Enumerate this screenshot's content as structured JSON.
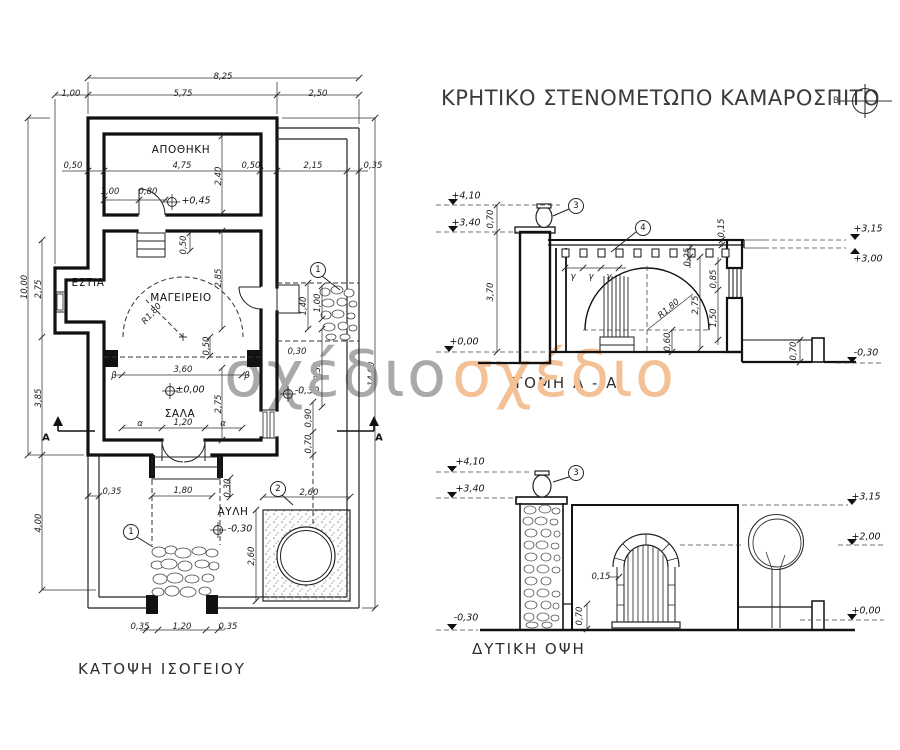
{
  "title": {
    "text": "ΚΡΗΤΙΚΟ ΣΤΕΝΟΜΕΤΩΠΟ ΚΑΜΑΡΟΣΠΙΤΟ"
  },
  "north": {
    "label": "Β"
  },
  "watermark": {
    "gray_text": "σχέδιο",
    "orange_text": "σχέδιο",
    "gray_color": "#a9a9a9",
    "orange_color": "#f4c096"
  },
  "captions": {
    "plan": "ΚΑΤΟΨΗ ΙΣΟΓΕΙΟΥ",
    "section": "ΤΟΜΗ Α - Α",
    "elevation": "ΔΥΤΙΚΗ ΟΨΗ"
  },
  "rooms": {
    "storage": "ΑΠΟΘΗΚΗ",
    "hearth": "ΕΣΤΙΑ",
    "kitchen": "ΜΑΓΕΙΡΕΙΟ",
    "hall": "ΣΑΛΑ",
    "courtyard": "ΑΥΛΗ"
  },
  "dims": {
    "8_25": "8,25",
    "1_00": "1,00",
    "5_75": "5,75",
    "2_50": "2,50",
    "0_50": "0,50",
    "4_75": "4,75",
    "2_15": "2,15",
    "0_35": "0,35",
    "2_40": "2,40",
    "0_80": "0,80",
    "10_00": "10,00",
    "2_75": "2,75",
    "3_85": "3,85",
    "4_00": "4,00",
    "14_00": "14,00",
    "2_85": "2,85",
    "1_40": "1,40",
    "0_30": "0,30",
    "2_35": "2,35",
    "3_60": "3,60",
    "0_90": "0,90",
    "0_70": "0,70",
    "1_20": "1,20",
    "1_80": "1,80",
    "2_60": "2,60",
    "3_70": "3,70",
    "0_15": "0,15",
    "0_25": "0,25",
    "0_85": "0,85",
    "1_50": "1,50",
    "0_60": "0,60",
    "r1_80": "R1,80"
  },
  "levels": {
    "p0_45": "+0,45",
    "pm0_00": "±0,00",
    "m0_30": "-0,30",
    "p4_10": "+4,10",
    "p3_40": "+3,40",
    "p0_00": "+0,00",
    "p3_15": "+3,15",
    "p3_00": "+3,00",
    "p2_00": "+2,00"
  },
  "marks": {
    "alpha": "α",
    "beta": "β",
    "gamma": "γ",
    "section_a": "Α",
    "north_b": "Β"
  },
  "callouts": {
    "c1": "1",
    "c2": "2",
    "c3": "3",
    "c4": "4"
  }
}
